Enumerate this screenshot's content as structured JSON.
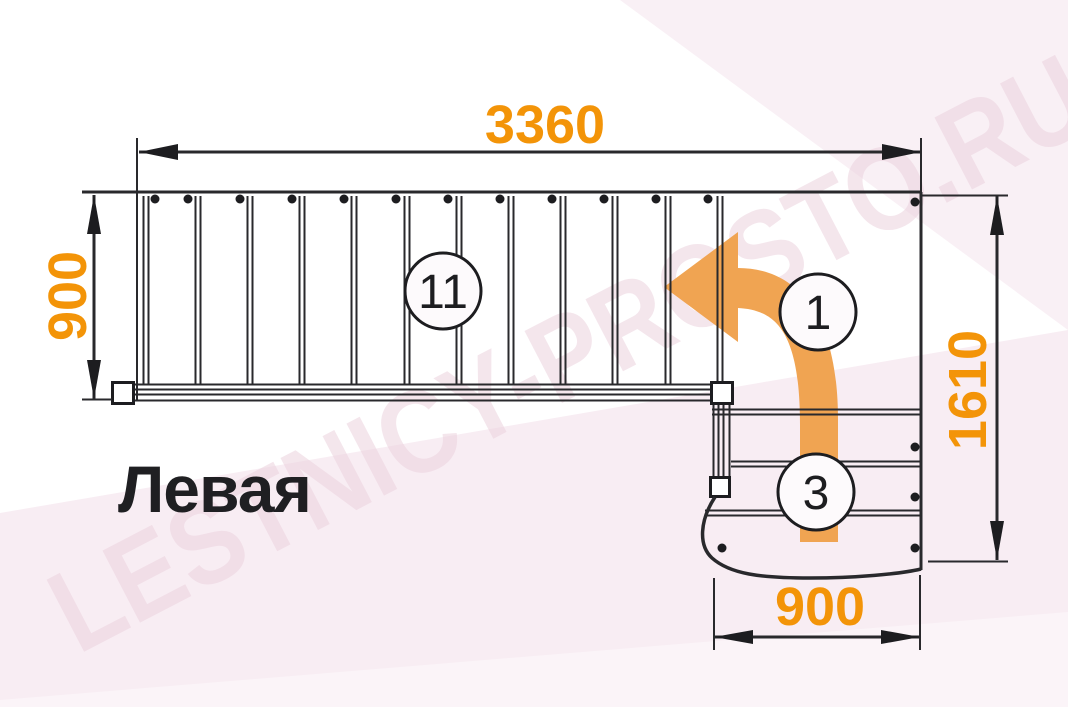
{
  "drawing": {
    "title": "Левая",
    "watermark": "LESTNICY-PROSTO.RU",
    "dimensions": {
      "top_width": "3360",
      "left_height": "900",
      "right_height": "1610",
      "bottom_width": "900"
    },
    "step_labels": {
      "main_flight": "11",
      "direction_start": "1",
      "lower_flight": "3"
    },
    "colors": {
      "dimension_text": "#f39408",
      "direction_arrow": "#f0a452",
      "linework": "#29292c",
      "watermark": "#ecd2de",
      "background_band": "#f8edf3",
      "background_band_light": "#fbf4f8",
      "canvas": "#ffffff"
    }
  }
}
